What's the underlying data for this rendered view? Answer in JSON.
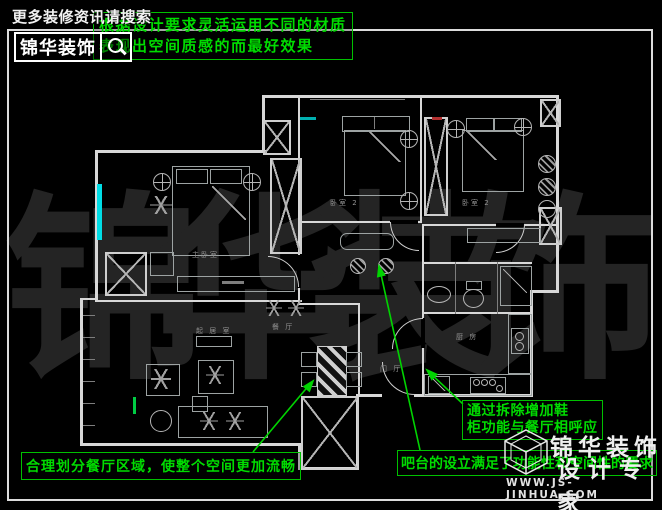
{
  "branding_top": {
    "search_hint": "更多装修资讯请搜索",
    "logo": "锦华装饰"
  },
  "branding_bottom": {
    "logo_line1": "锦华装饰",
    "logo_line2": "设计专家",
    "website": "WWW.JS-JINHUA.COM"
  },
  "watermark": {
    "text": "锦华装饰"
  },
  "annotations": {
    "material_line1": "根据设计要求灵活运用不同的材质",
    "material_line2": "表现出空间质感的而最好效果",
    "dining": "合理划分餐厅区域，使整个空间更加流畅",
    "shoe_line1": "通过拆除增加鞋",
    "shoe_line2": "柜功能与餐厅相呼应",
    "bar": "吧台的设立满足了功能性和空间性的要求"
  },
  "floorplan": {
    "rooms": [
      {
        "label": "主卧室"
      },
      {
        "label": "卧室 2"
      },
      {
        "label": "卧室 2"
      },
      {
        "label": "起 居 室"
      },
      {
        "label": "餐 厅"
      },
      {
        "label": "门 厅"
      },
      {
        "label": "厨 房"
      }
    ]
  },
  "colors": {
    "annotation_green": "#00d400",
    "window_cyan": "#00dde6",
    "wall_white": "#d8d8d8",
    "watermark_gray": "#242424",
    "marker_red": "#b23030"
  }
}
